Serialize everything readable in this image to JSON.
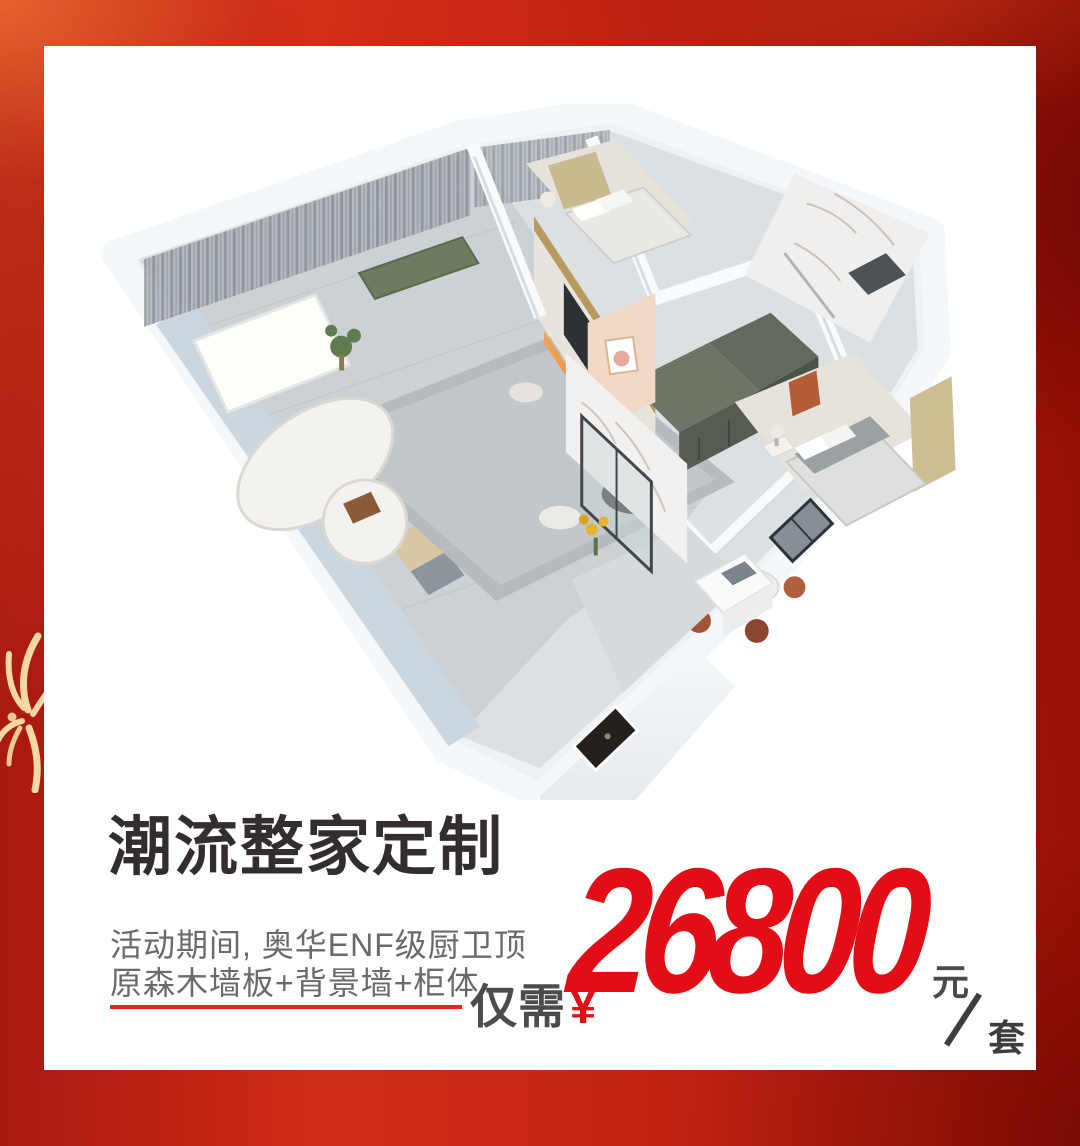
{
  "poster": {
    "headline": "潮流整家定制",
    "subline1": "活动期间, 奥华ENF级厨卫顶",
    "subline2": "原森木墙板+背景墙+柜体",
    "price_label": "仅需",
    "currency_symbol": "¥",
    "price_amount": "26800",
    "price_unit_top": "元",
    "price_unit_slash": "/",
    "price_unit_bottom": "套"
  },
  "colors": {
    "background_red": "#c1200f",
    "background_red_bright": "#e0502a",
    "background_red_dark": "#a01107",
    "accent_red": "#e30d16",
    "headline_gray": "#332e2d",
    "subtitle_gray": "#6a6a6a",
    "price_label_gray": "#4c4c4c",
    "firework_cream": "#f5d7a3",
    "card_white": "#ffffff"
  },
  "icons": {
    "firework": "firework-burst",
    "price_slash": "/"
  }
}
